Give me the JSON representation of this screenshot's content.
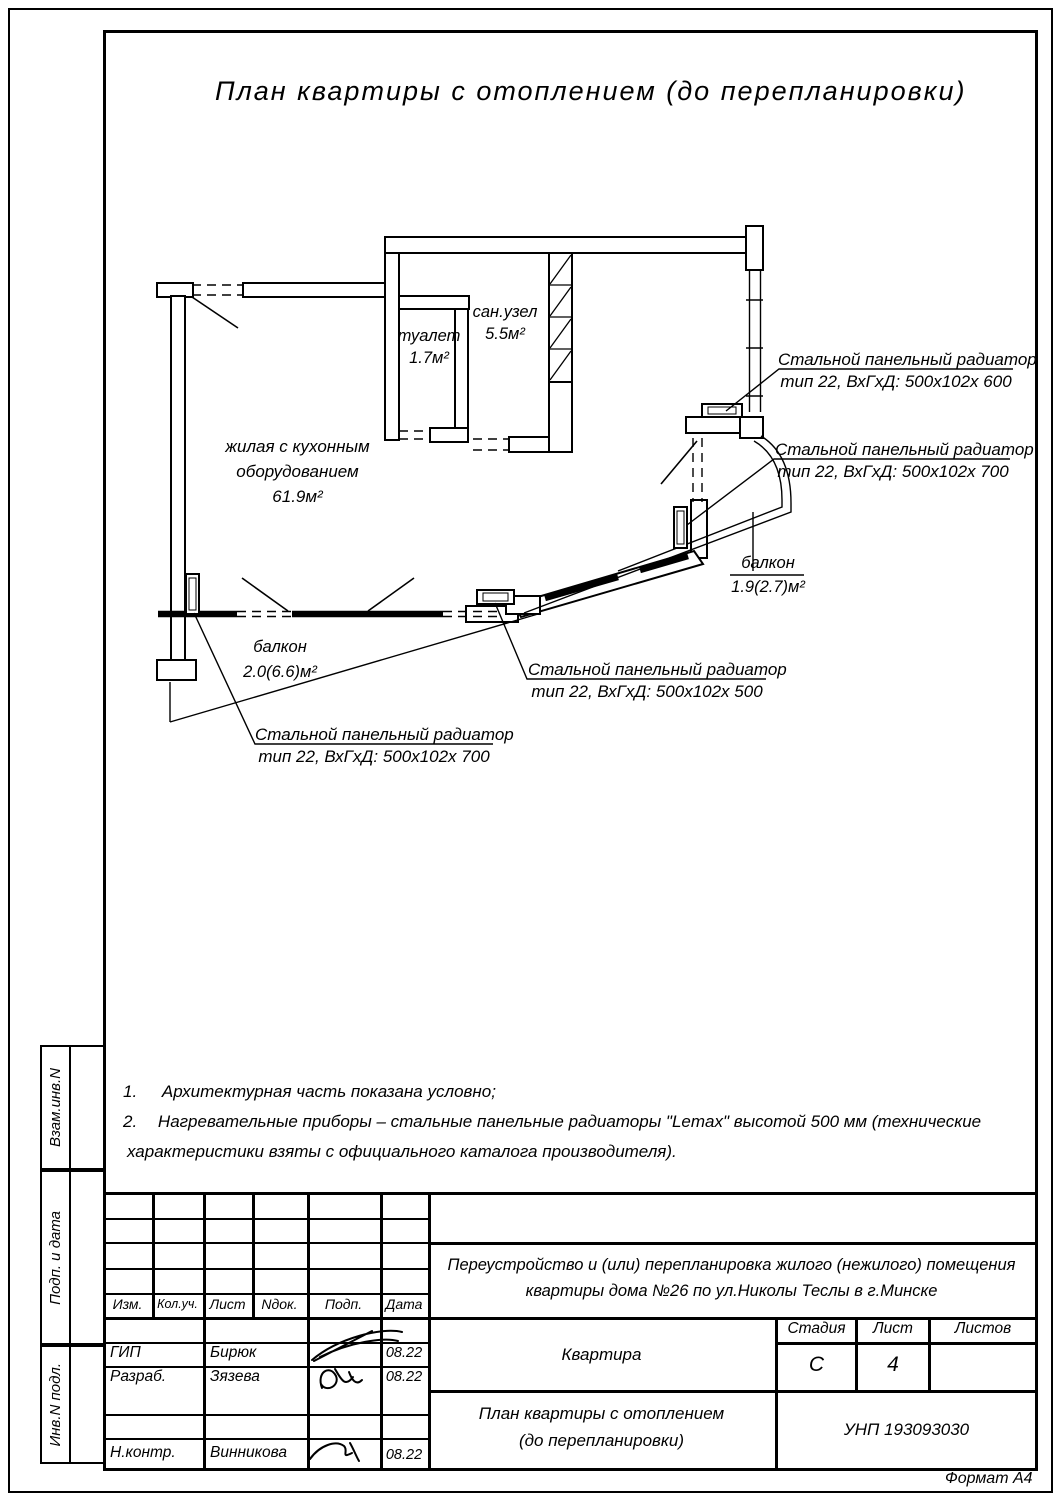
{
  "sheet": {
    "title": "План квартиры с отоплением (до перепланировки)",
    "format_label": "Формат А4"
  },
  "plan": {
    "rooms": {
      "toilet": {
        "name": "туалет",
        "area": "1.7м²"
      },
      "bathroom": {
        "name": "сан.узел",
        "area": "5.5м²"
      },
      "living": {
        "line1": "жилая с кухонным",
        "line2": "оборудованием",
        "area": "61.9м²"
      }
    },
    "balconies": {
      "right": {
        "name": "балкон",
        "area": "1.9(2.7)м²"
      },
      "left": {
        "name": "балкон",
        "area": "2.0(6.6)м²"
      }
    },
    "callouts": {
      "c1": {
        "line1": "Стальной панельный радиатор",
        "line2": "тип 22, ВхГхД: 500х102х 600"
      },
      "c2": {
        "line1": "Стальной панельный радиатор",
        "line2": "тип 22, ВхГхД: 500х102х 700"
      },
      "c3": {
        "line1": "Стальной панельный радиатор",
        "line2": "тип 22, ВхГхД: 500х102х 500"
      },
      "c4": {
        "line1": "Стальной панельный радиатор",
        "line2": "тип 22, ВхГхД: 500х102х 700"
      }
    }
  },
  "notes": {
    "n1_num": "1.",
    "n1_text": "Архитектурная часть показана условно;",
    "n2_num": "2.",
    "n2_text": "Нагревательные приборы – стальные панельные радиаторы \"Lemax\" высотой 500 мм (технические",
    "n3_text": "характеристики взяты с официального каталога производителя)."
  },
  "side_strip": {
    "cell1": "Взам.инв.N",
    "cell2": "Подп. и дата",
    "cell3": "Инв.N подл."
  },
  "title_block": {
    "cols": {
      "c1": "Изм.",
      "c2": "Кол.уч.",
      "c3": "Лист",
      "c4": "Nдок.",
      "c5": "Подп.",
      "c6": "Дата"
    },
    "project_line1": "Переустройство и (или) перепланировка жилого (нежилого) помещения",
    "project_line2": "квартиры дома №26 по ул.Николы Теслы в г.Минске",
    "object_name": "Квартира",
    "stage_label": "Стадия",
    "sheet_label": "Лист",
    "sheets_label": "Листов",
    "stage_value": "С",
    "sheet_value": "4",
    "sheets_value": "",
    "doc_line1": "План квартиры с отоплением",
    "doc_line2": "(до перепланировки)",
    "unp": "УНП 193093030",
    "staff": {
      "r1": {
        "role": "ГИП",
        "name": "Бирюк",
        "date": "08.22"
      },
      "r2": {
        "role": "Разраб.",
        "name": "Зязева",
        "date": "08.22"
      },
      "r3": {
        "role": "Н.контр.",
        "name": "Винникова",
        "date": "08.22"
      }
    }
  }
}
